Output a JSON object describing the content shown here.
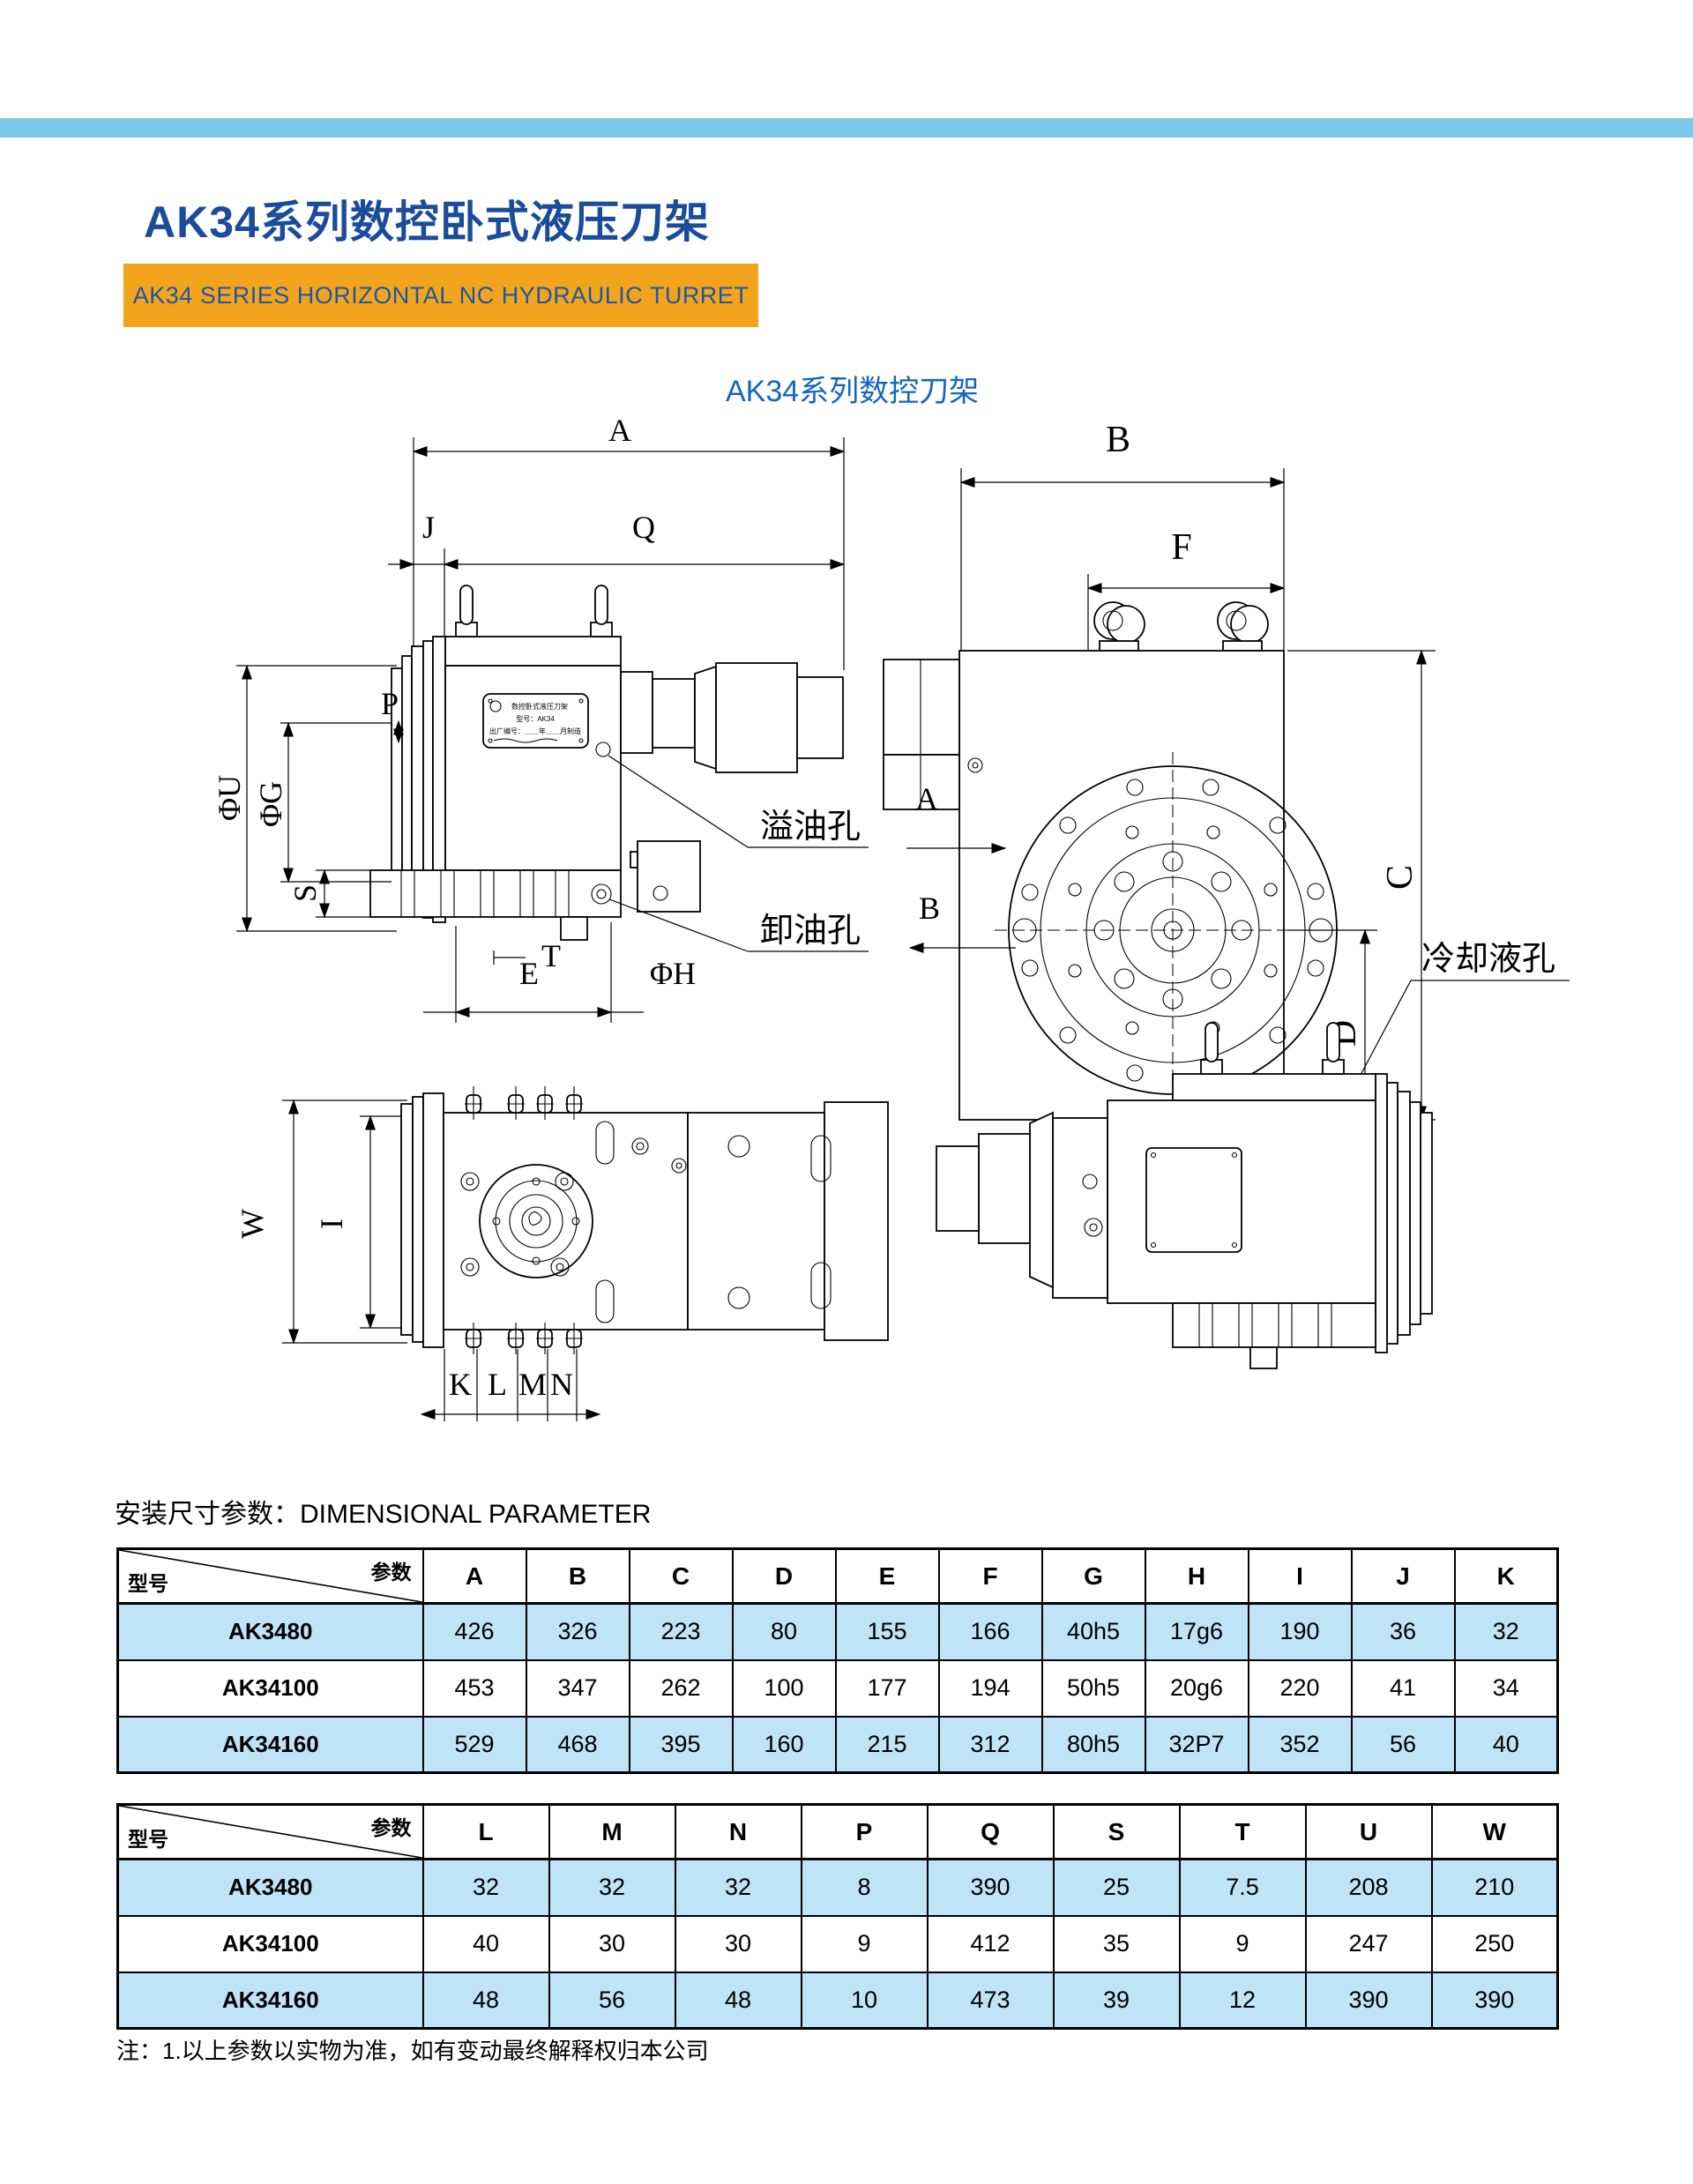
{
  "colors": {
    "top_bar": "#7dc8e9",
    "title_blue": "#1a4c9b",
    "banner_orange": "#f2a41c",
    "banner_text_blue": "#1d57a5",
    "caption_blue": "#1565c0",
    "table_row_blue": "#bfe3f7"
  },
  "header": {
    "title": "AK34系列数控卧式液压刀架",
    "banner": "AK34 SERIES HORIZONTAL NC HYDRAULIC TURRET",
    "caption": "AK34系列数控刀架"
  },
  "drawing": {
    "dims": {
      "A": "A",
      "B": "B",
      "C": "C",
      "D": "D",
      "E": "E",
      "F": "F",
      "I": "I",
      "J": "J",
      "K": "K",
      "L": "L",
      "M": "M",
      "N": "N",
      "P": "P",
      "Q": "Q",
      "S": "S",
      "T": "T",
      "W": "W",
      "phiU": "ΦU",
      "phiG": "ΦG",
      "phiH": "ΦH"
    },
    "view_arrows": {
      "a": "A",
      "b": "B"
    },
    "ann": {
      "overflow": "溢油孔",
      "drain": "卸油孔",
      "coolant": "冷却液孔"
    },
    "nameplate": {
      "l1": "数控卧式液压刀架",
      "l2": "型号：AK34",
      "l3": "出厂编号：＿＿年＿＿月制造"
    }
  },
  "section": {
    "label_cn": "安装尺寸参数：",
    "label_en": "DIMENSIONAL PARAMETER"
  },
  "tables": {
    "corner": {
      "param": "参数",
      "model": "型号"
    },
    "t1": {
      "columns": [
        "A",
        "B",
        "C",
        "D",
        "E",
        "F",
        "G",
        "H",
        "I",
        "J",
        "K"
      ],
      "rows": [
        {
          "model": "AK3480",
          "values": [
            "426",
            "326",
            "223",
            "80",
            "155",
            "166",
            "40h5",
            "17g6",
            "190",
            "36",
            "32"
          ]
        },
        {
          "model": "AK34100",
          "values": [
            "453",
            "347",
            "262",
            "100",
            "177",
            "194",
            "50h5",
            "20g6",
            "220",
            "41",
            "34"
          ]
        },
        {
          "model": "AK34160",
          "values": [
            "529",
            "468",
            "395",
            "160",
            "215",
            "312",
            "80h5",
            "32P7",
            "352",
            "56",
            "40"
          ]
        }
      ]
    },
    "t2": {
      "columns": [
        "L",
        "M",
        "N",
        "P",
        "Q",
        "S",
        "T",
        "U",
        "W"
      ],
      "rows": [
        {
          "model": "AK3480",
          "values": [
            "32",
            "32",
            "32",
            "8",
            "390",
            "25",
            "7.5",
            "208",
            "210"
          ]
        },
        {
          "model": "AK34100",
          "values": [
            "40",
            "30",
            "30",
            "9",
            "412",
            "35",
            "9",
            "247",
            "250"
          ]
        },
        {
          "model": "AK34160",
          "values": [
            "48",
            "56",
            "48",
            "10",
            "473",
            "39",
            "12",
            "390",
            "390"
          ]
        }
      ]
    }
  },
  "footnote": "注：1.以上参数以实物为准，如有变动最终解释权归本公司"
}
